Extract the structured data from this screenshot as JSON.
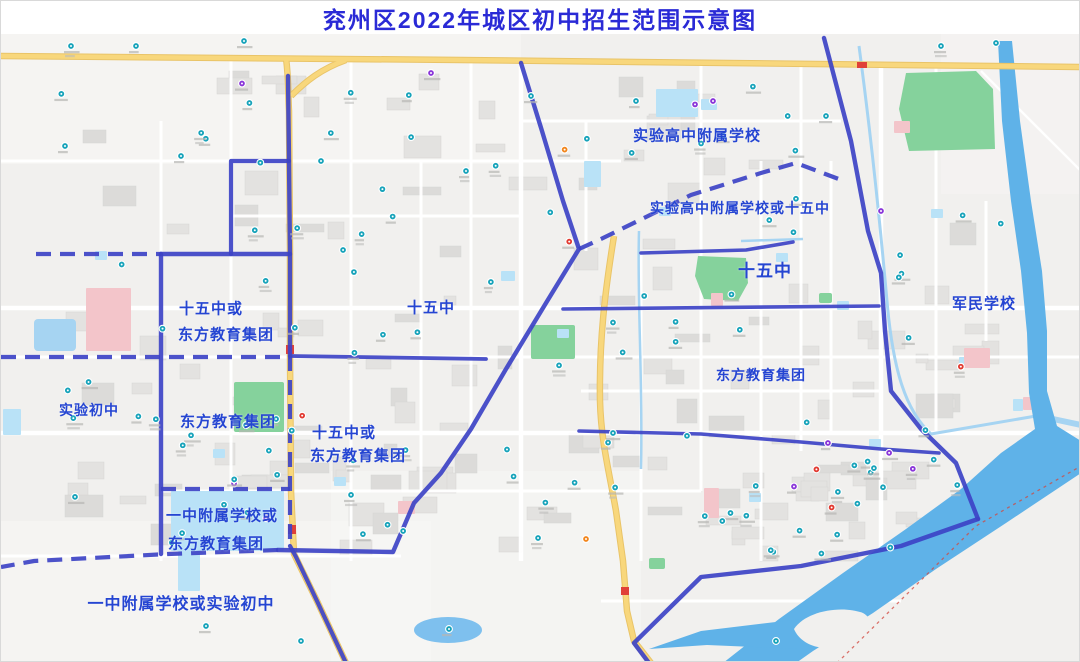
{
  "title": "兖州区2022年城区初中招生范围示意图",
  "map": {
    "zone_labels": [
      {
        "text": "实验高中附属学校",
        "x": 696,
        "y": 134,
        "size": 15
      },
      {
        "text": "实验高中附属学校或十五中",
        "x": 739,
        "y": 207,
        "size": 14
      },
      {
        "text": "十五中或",
        "x": 210,
        "y": 307,
        "size": 15
      },
      {
        "text": "东方教育集团",
        "x": 225,
        "y": 333,
        "size": 15
      },
      {
        "text": "十五中",
        "x": 430,
        "y": 306,
        "size": 15
      },
      {
        "text": "十五中",
        "x": 764,
        "y": 268,
        "size": 17
      },
      {
        "text": "军民学校",
        "x": 983,
        "y": 302,
        "size": 15
      },
      {
        "text": "实验初中",
        "x": 88,
        "y": 409,
        "size": 14
      },
      {
        "text": "东方教育集团",
        "x": 227,
        "y": 420,
        "size": 15
      },
      {
        "text": "十五中或",
        "x": 343,
        "y": 431,
        "size": 15
      },
      {
        "text": "东方教育集团",
        "x": 357,
        "y": 454,
        "size": 15
      },
      {
        "text": "东方教育集团",
        "x": 760,
        "y": 374,
        "size": 14
      },
      {
        "text": "一中附属学校或",
        "x": 221,
        "y": 514,
        "size": 15
      },
      {
        "text": "东方教育集团",
        "x": 215,
        "y": 542,
        "size": 15
      },
      {
        "text": "一中附属学校或实验初中",
        "x": 180,
        "y": 601,
        "size": 16
      }
    ],
    "colors": {
      "title_text": "#2a2ad6",
      "label_text": "#2545d2",
      "boundary": "#3d43c6",
      "river": "#5fb2e8",
      "canal": "#a6d4f2",
      "park": "#85d29c",
      "school_zone": "#b9e2f7",
      "hospital_pink": "#f3c5ca",
      "road_yellow": "#f8d77c",
      "building": "#e3e2e0",
      "background": "#f1f0ee",
      "poi_teal": "#17a3ba",
      "poi_purple": "#8a36d9",
      "poi_red": "#e23a31",
      "poi_orange": "#f2861d",
      "railway_red": "#d2473e"
    }
  }
}
